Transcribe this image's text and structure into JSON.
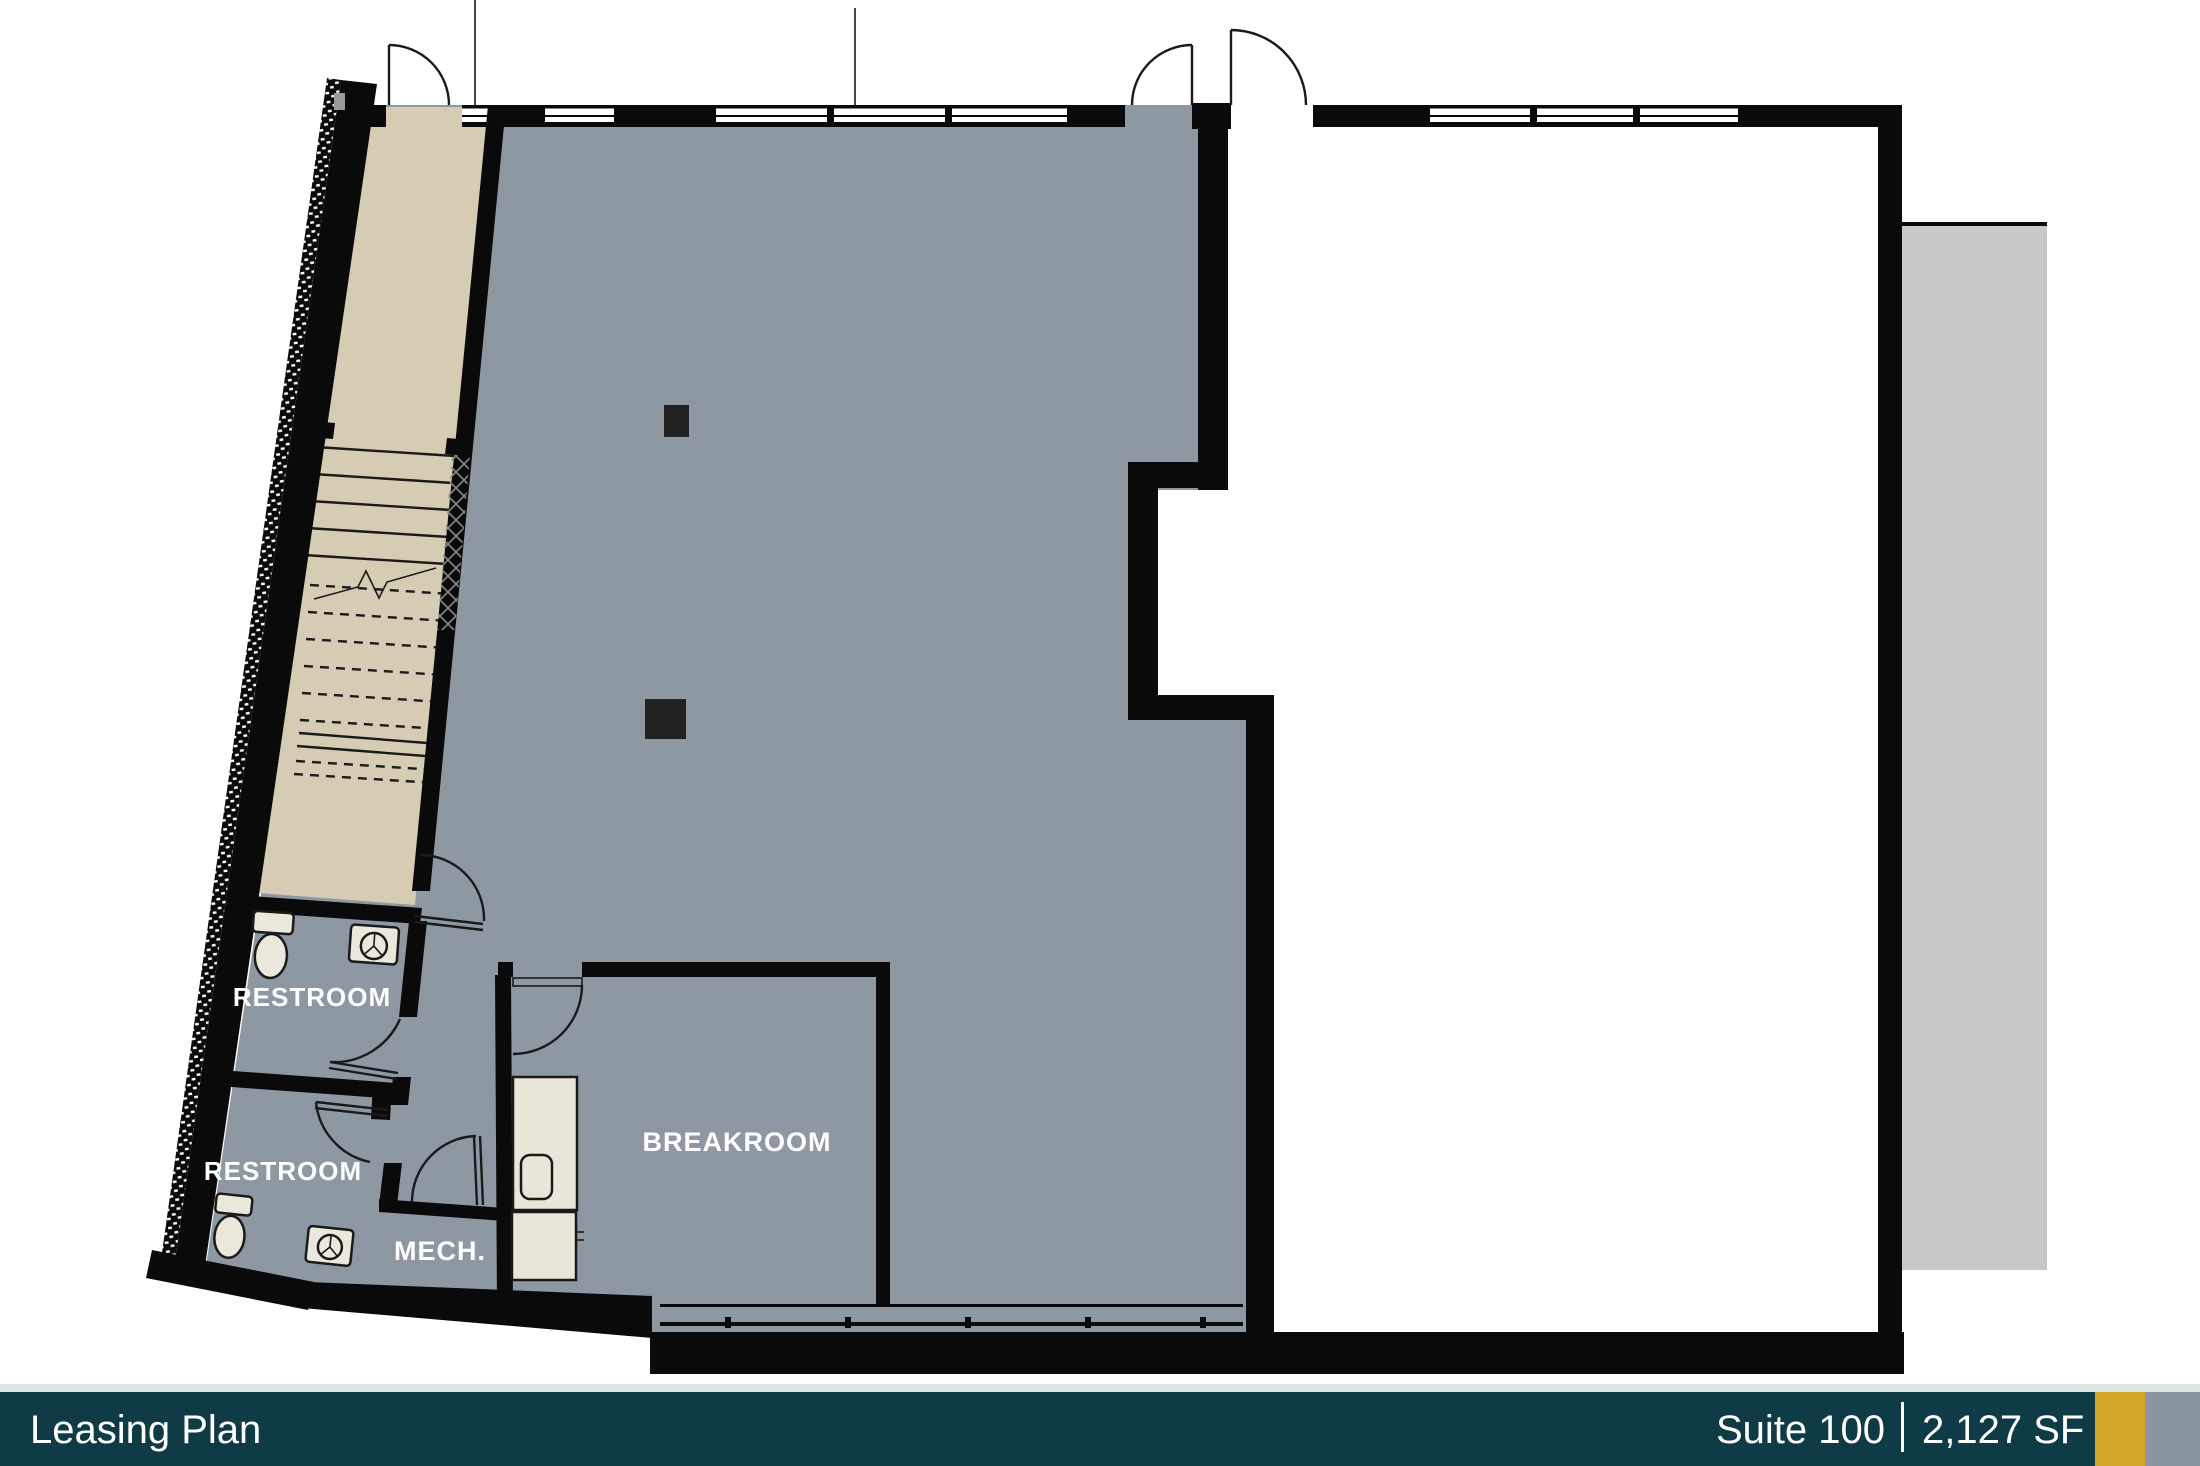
{
  "footer": {
    "left_label": "Leasing Plan",
    "suite_label": "Suite 100",
    "area_label": "2,127 SF"
  },
  "rooms": {
    "restroom_upper": "RESTROOM",
    "restroom_lower": "RESTROOM",
    "mech": "MECH.",
    "breakroom": "BREAKROOM"
  },
  "colors": {
    "suite_fill": "#8d98a3",
    "vacant_fill": "#ffffff",
    "stair_fill": "#d6ccb4",
    "wall": "#0a0a0a",
    "line": "#1a1a1a",
    "column": "#222222",
    "fixture": "#ebe8db",
    "counter": "#e9e5d8",
    "backdrop": "#c7c8c9",
    "label": "#ffffff",
    "footer_bar": "#0f3b47",
    "footer_gold": "#d6a62b",
    "footer_gray": "#8a95a1",
    "footer_topline": "#dde4e4"
  }
}
